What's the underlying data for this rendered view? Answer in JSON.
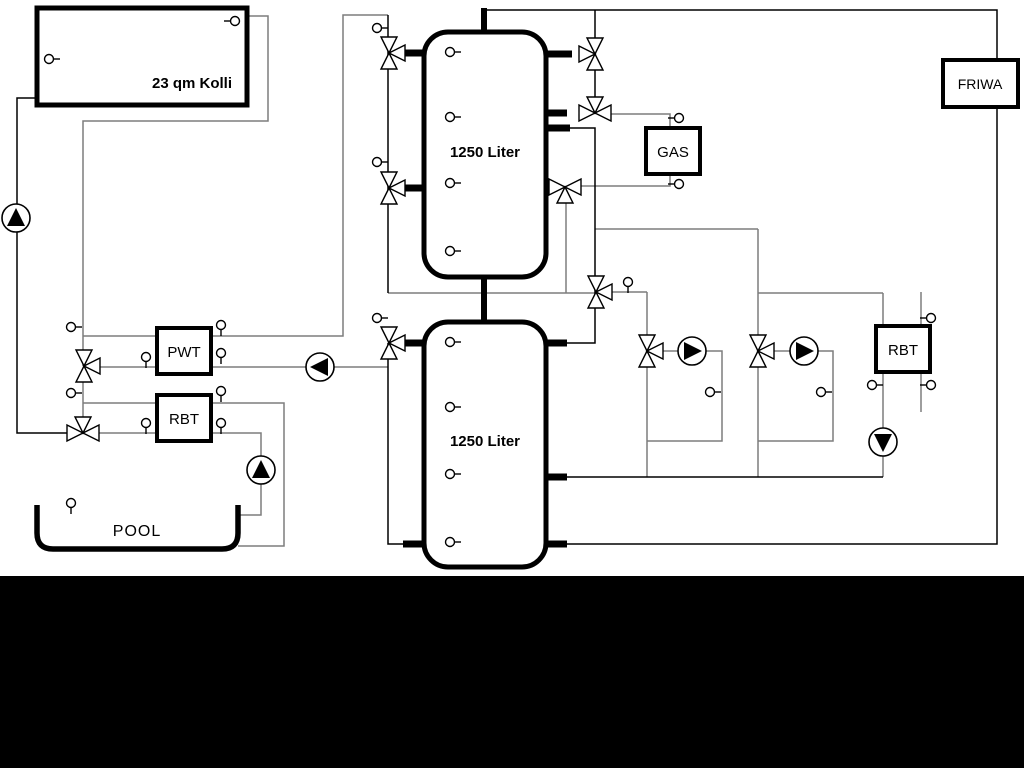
{
  "window": {
    "background": "#ffffff",
    "bottom_bar_color": "#000000"
  },
  "diagram": {
    "solar_collector": {
      "label": "23 qm Kolli"
    },
    "buffer_tank_upper": {
      "label": "1250 Liter"
    },
    "buffer_tank_lower": {
      "label": "1250 Liter"
    },
    "pool_heat_exchanger": {
      "label": "PWT"
    },
    "pool_return_unit": {
      "label": "RBT"
    },
    "gas_boiler": {
      "label": "GAS"
    },
    "fresh_water_station": {
      "label": "FRIWA"
    },
    "hot_water_return_unit": {
      "label": "RBT"
    },
    "pool": {
      "label": "POOL"
    },
    "colors": {
      "pipe_gray": "#7d7d7d",
      "pipe_black": "#000000",
      "component_stroke": "#000000",
      "component_fill": "#ffffff"
    },
    "components": {
      "pump_count": 6,
      "three_way_valve_count": 11,
      "sensor_count": 30
    }
  }
}
